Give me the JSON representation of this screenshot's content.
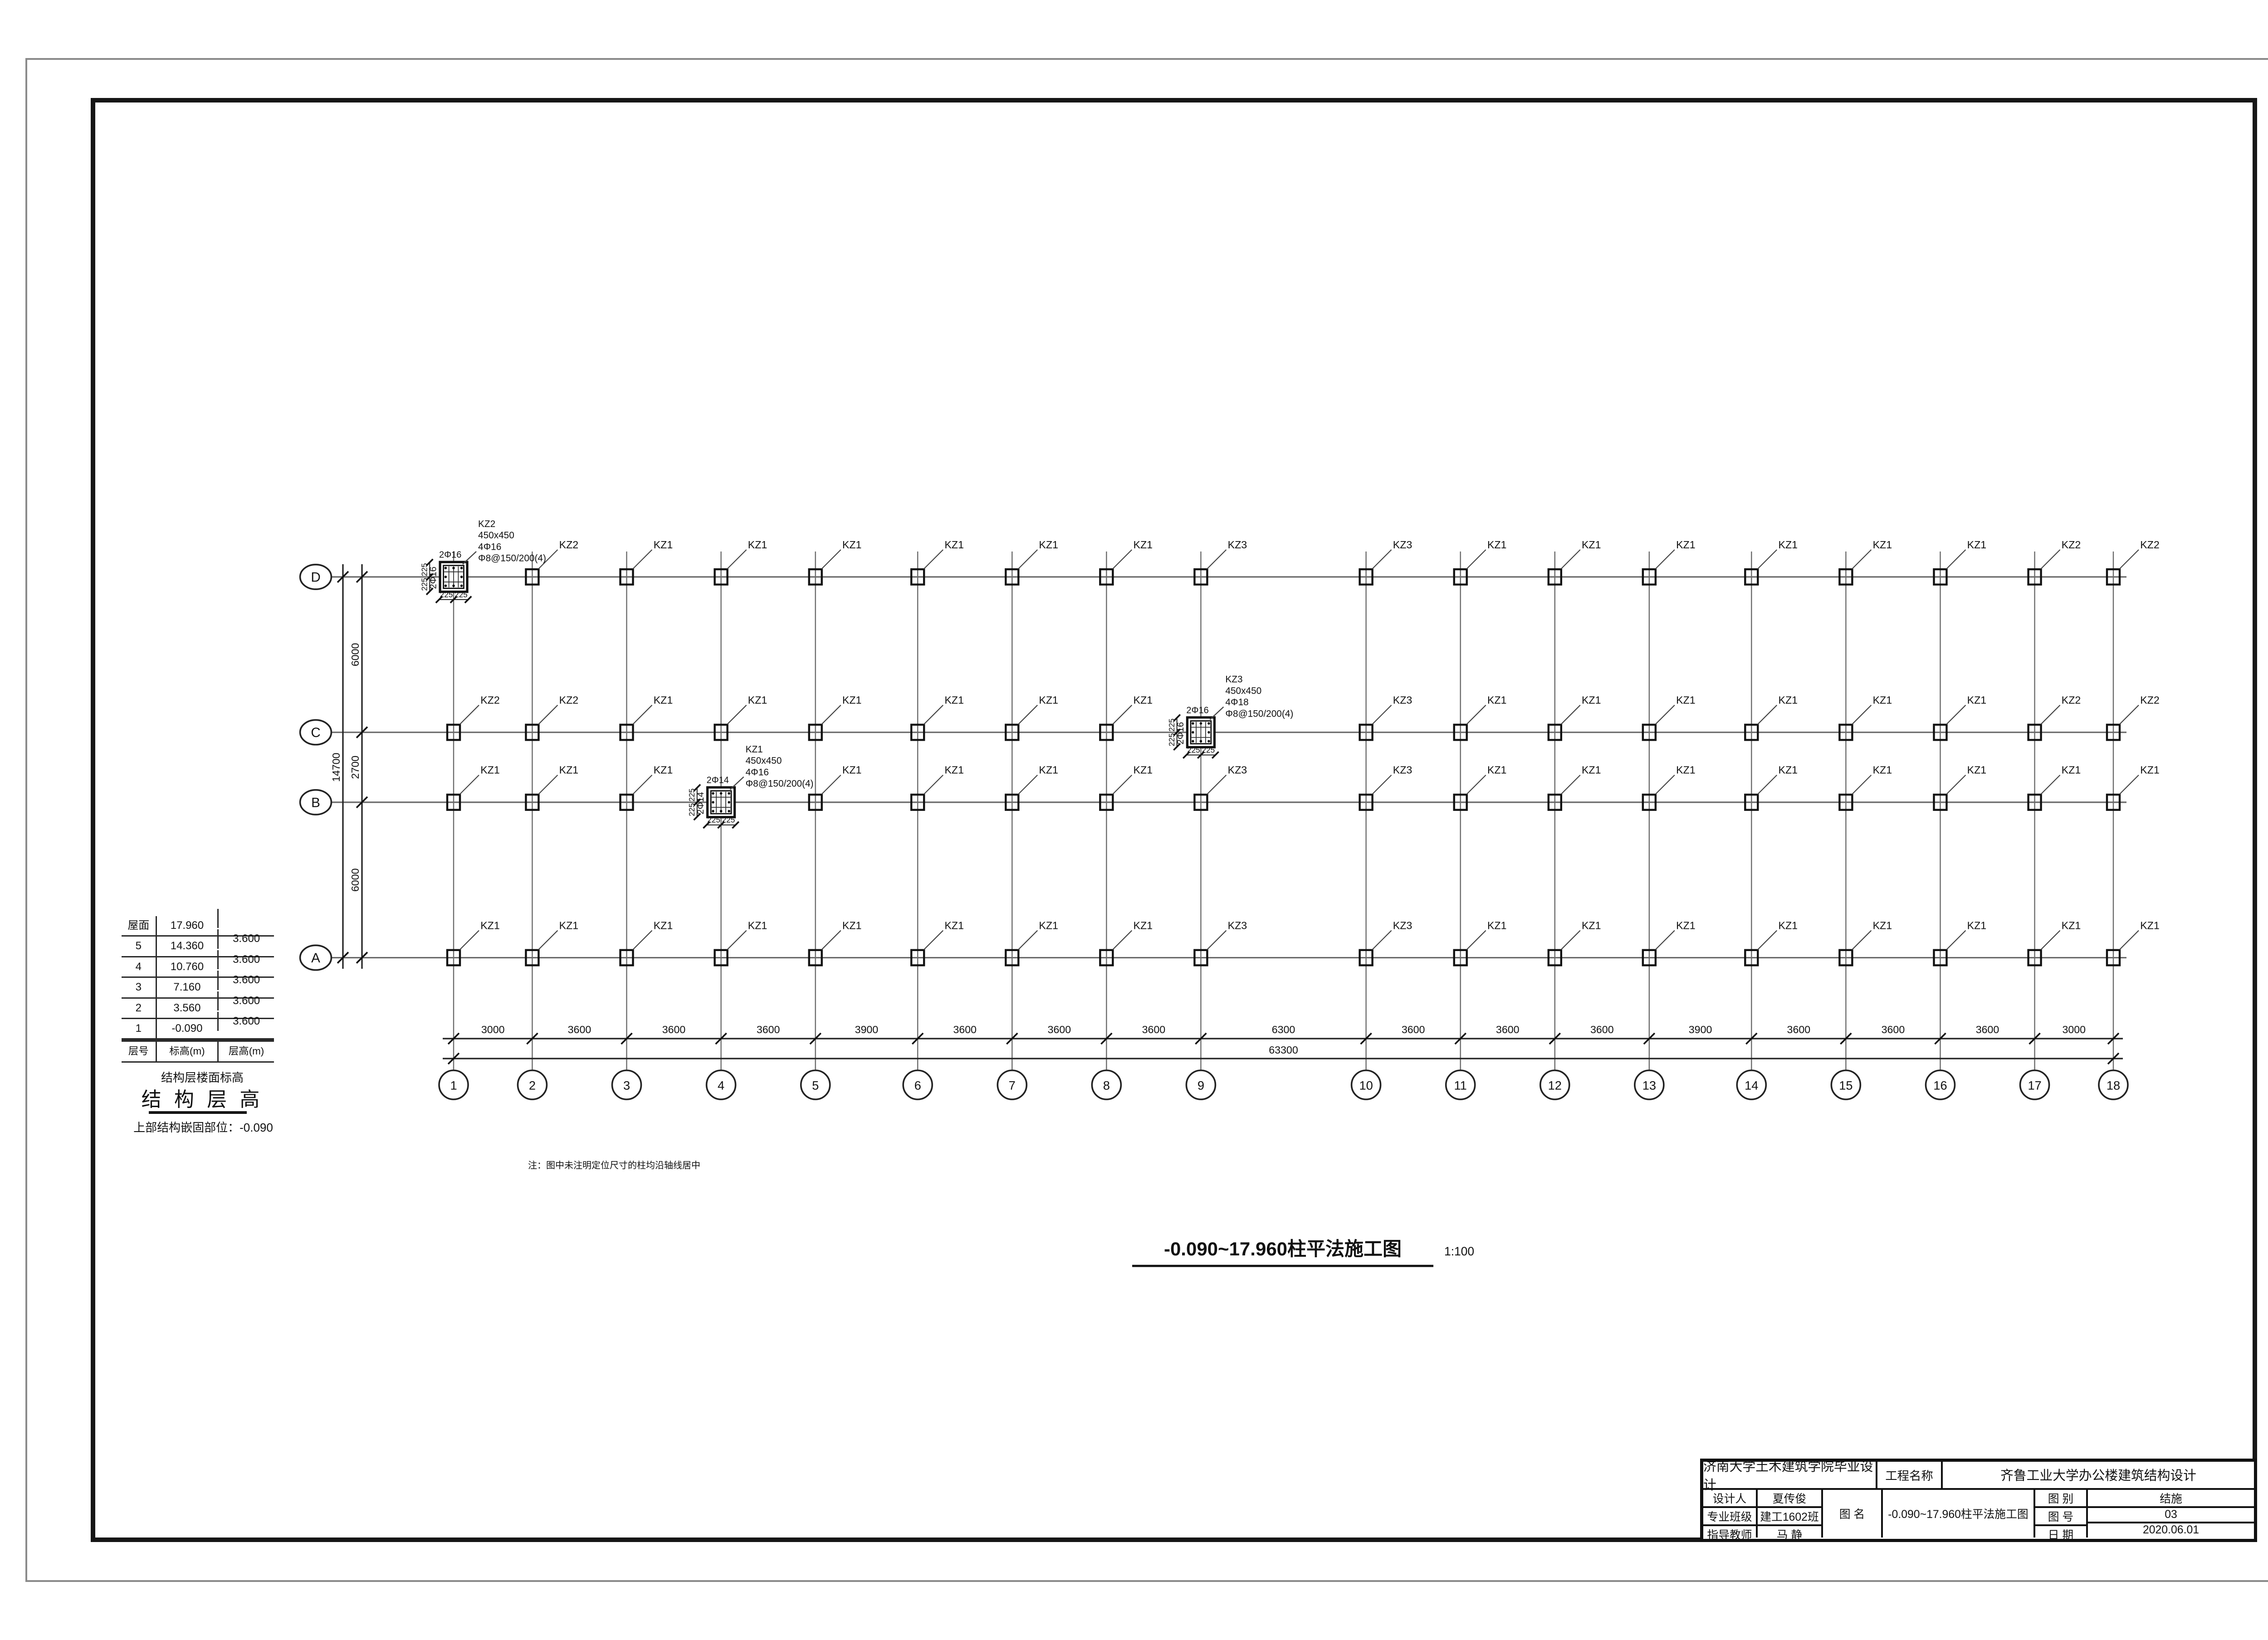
{
  "sheet": {
    "title": "-0.090~17.960柱平法施工图",
    "title_scale": "1:100",
    "note": "注：图中未注明定位尺寸的柱均沿轴线居中"
  },
  "floor_table": {
    "header": [
      "层号",
      "标高(m)",
      "层高(m)"
    ],
    "rows": [
      [
        "屋面",
        "17.960",
        ""
      ],
      [
        "5",
        "14.360",
        "3.600"
      ],
      [
        "4",
        "10.760",
        "3.600"
      ],
      [
        "3",
        "7.160",
        "3.600"
      ],
      [
        "2",
        "3.560",
        "3.600"
      ],
      [
        "1",
        "-0.090",
        "3.600"
      ]
    ],
    "caption_small": "结构层楼面标高",
    "caption_large": "结 构 层 高",
    "caption_note": "上部结构嵌固部位：-0.090"
  },
  "plan": {
    "x_axis_labels": [
      "1",
      "2",
      "3",
      "4",
      "5",
      "6",
      "7",
      "8",
      "9",
      "10",
      "11",
      "12",
      "13",
      "14",
      "15",
      "16",
      "17",
      "18"
    ],
    "x_spacings_mm": [
      3000,
      3600,
      3600,
      3600,
      3900,
      3600,
      3600,
      3600,
      6300,
      3600,
      3600,
      3600,
      3900,
      3600,
      3600,
      3600,
      3000
    ],
    "x_total": "63300",
    "y_axis_labels": [
      "D",
      "C",
      "B",
      "A"
    ],
    "y_spacings_mm": [
      6000,
      2700,
      6000
    ],
    "y_total": "14700",
    "column_labels": {
      "D": [
        "KZ2",
        "KZ2",
        "KZ1",
        "KZ1",
        "KZ1",
        "KZ1",
        "KZ1",
        "KZ1",
        "KZ3",
        "KZ3",
        "KZ1",
        "KZ1",
        "KZ1",
        "KZ1",
        "KZ1",
        "KZ1",
        "KZ2",
        "KZ2"
      ],
      "C": [
        "KZ2",
        "KZ2",
        "KZ1",
        "KZ1",
        "KZ1",
        "KZ1",
        "KZ1",
        "KZ1",
        "KZ3",
        "KZ3",
        "KZ1",
        "KZ1",
        "KZ1",
        "KZ1",
        "KZ1",
        "KZ1",
        "KZ2",
        "KZ2"
      ],
      "B": [
        "KZ1",
        "KZ1",
        "KZ1",
        "KZ1",
        "KZ1",
        "KZ1",
        "KZ1",
        "KZ1",
        "KZ3",
        "KZ3",
        "KZ1",
        "KZ1",
        "KZ1",
        "KZ1",
        "KZ1",
        "KZ1",
        "KZ1",
        "KZ1"
      ],
      "A": [
        "KZ1",
        "KZ1",
        "KZ1",
        "KZ1",
        "KZ1",
        "KZ1",
        "KZ1",
        "KZ1",
        "KZ3",
        "KZ3",
        "KZ1",
        "KZ1",
        "KZ1",
        "KZ1",
        "KZ1",
        "KZ1",
        "KZ1",
        "KZ1"
      ]
    },
    "details": [
      {
        "row": "D",
        "axis_index": 0,
        "name": "KZ2",
        "size": "450x450",
        "rebar": "4Φ16",
        "stirrup": "Φ8@150/200(4)",
        "top_bars": "2Φ16",
        "side_bars": "2Φ16",
        "dim_a": "225",
        "dim_b": "225"
      },
      {
        "row": "C",
        "axis_index": 8,
        "name": "KZ3",
        "size": "450x450",
        "rebar": "4Φ18",
        "stirrup": "Φ8@150/200(4)",
        "top_bars": "2Φ16",
        "side_bars": "2Φ16",
        "dim_a": "225",
        "dim_b": "225"
      },
      {
        "row": "B",
        "axis_index": 3,
        "name": "KZ1",
        "size": "450x450",
        "rebar": "4Φ16",
        "stirrup": "Φ8@150/200(4)",
        "top_bars": "2Φ14",
        "side_bars": "2Φ14",
        "dim_a": "225",
        "dim_b": "225"
      }
    ]
  },
  "title_block": {
    "school": "济南大学土木建筑学院毕业设计",
    "project_label": "工程名称",
    "project_name": "齐鲁工业大学办公楼建筑结构设计",
    "designer_label": "设计人",
    "designer": "夏传俊",
    "class_label": "专业班级",
    "class_value": "建工1602班",
    "advisor_label": "指导教师",
    "advisor": "马 静",
    "drawing_label": "图  名",
    "drawing_name": "-0.090~17.960柱平法施工图",
    "category_label": "图  别",
    "category": "结施",
    "number_label": "图  号",
    "number": "03",
    "date_label": "日  期",
    "date": "2020.06.01"
  }
}
